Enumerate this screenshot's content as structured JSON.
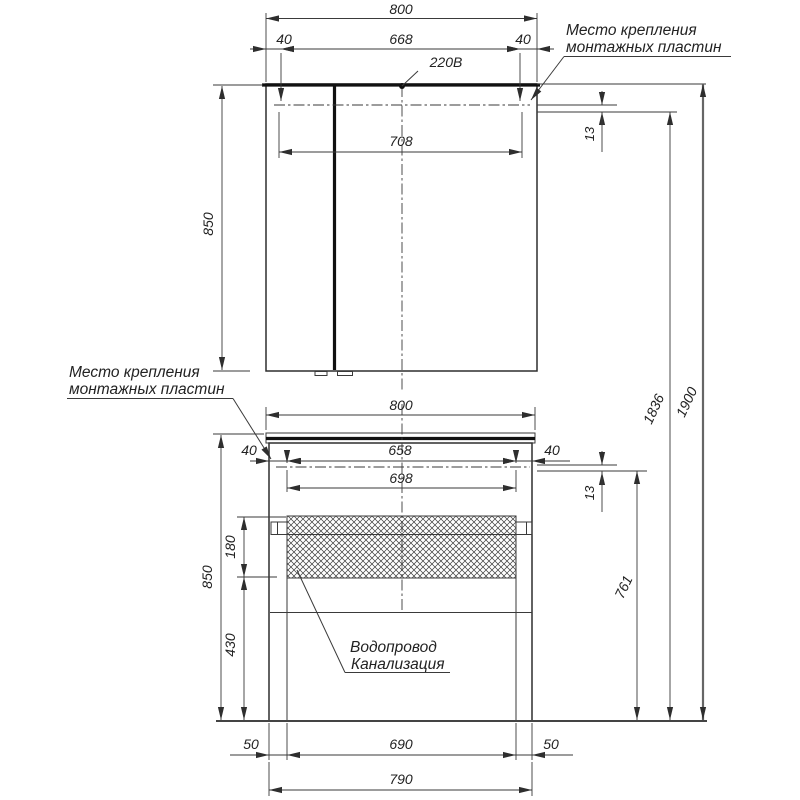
{
  "upper_unit": {
    "overall_width": "800",
    "plate_offset_left": "40",
    "plate_span": "668",
    "plate_offset_right": "40",
    "inner_span": "708",
    "height": "850",
    "plate_gap": "13",
    "power_label": "220В"
  },
  "lower_unit": {
    "overall_width": "800",
    "plate_offset_left": "40",
    "plate_span": "658",
    "plate_offset_right": "40",
    "inner_span": "698",
    "height": "850",
    "plate_gap": "13",
    "opening_height": "180",
    "bottom_height": "430",
    "plate_to_floor": "761",
    "base_left": "50",
    "base_span": "690",
    "base_right": "50",
    "base_width": "790"
  },
  "overall": {
    "floor_to_plates": "1836",
    "floor_to_top": "1900"
  },
  "annotations": {
    "mount_line1": "Место крепления",
    "mount_line2": "монтажных пластин",
    "water": "Водопровод",
    "sewage": "Канализация"
  }
}
